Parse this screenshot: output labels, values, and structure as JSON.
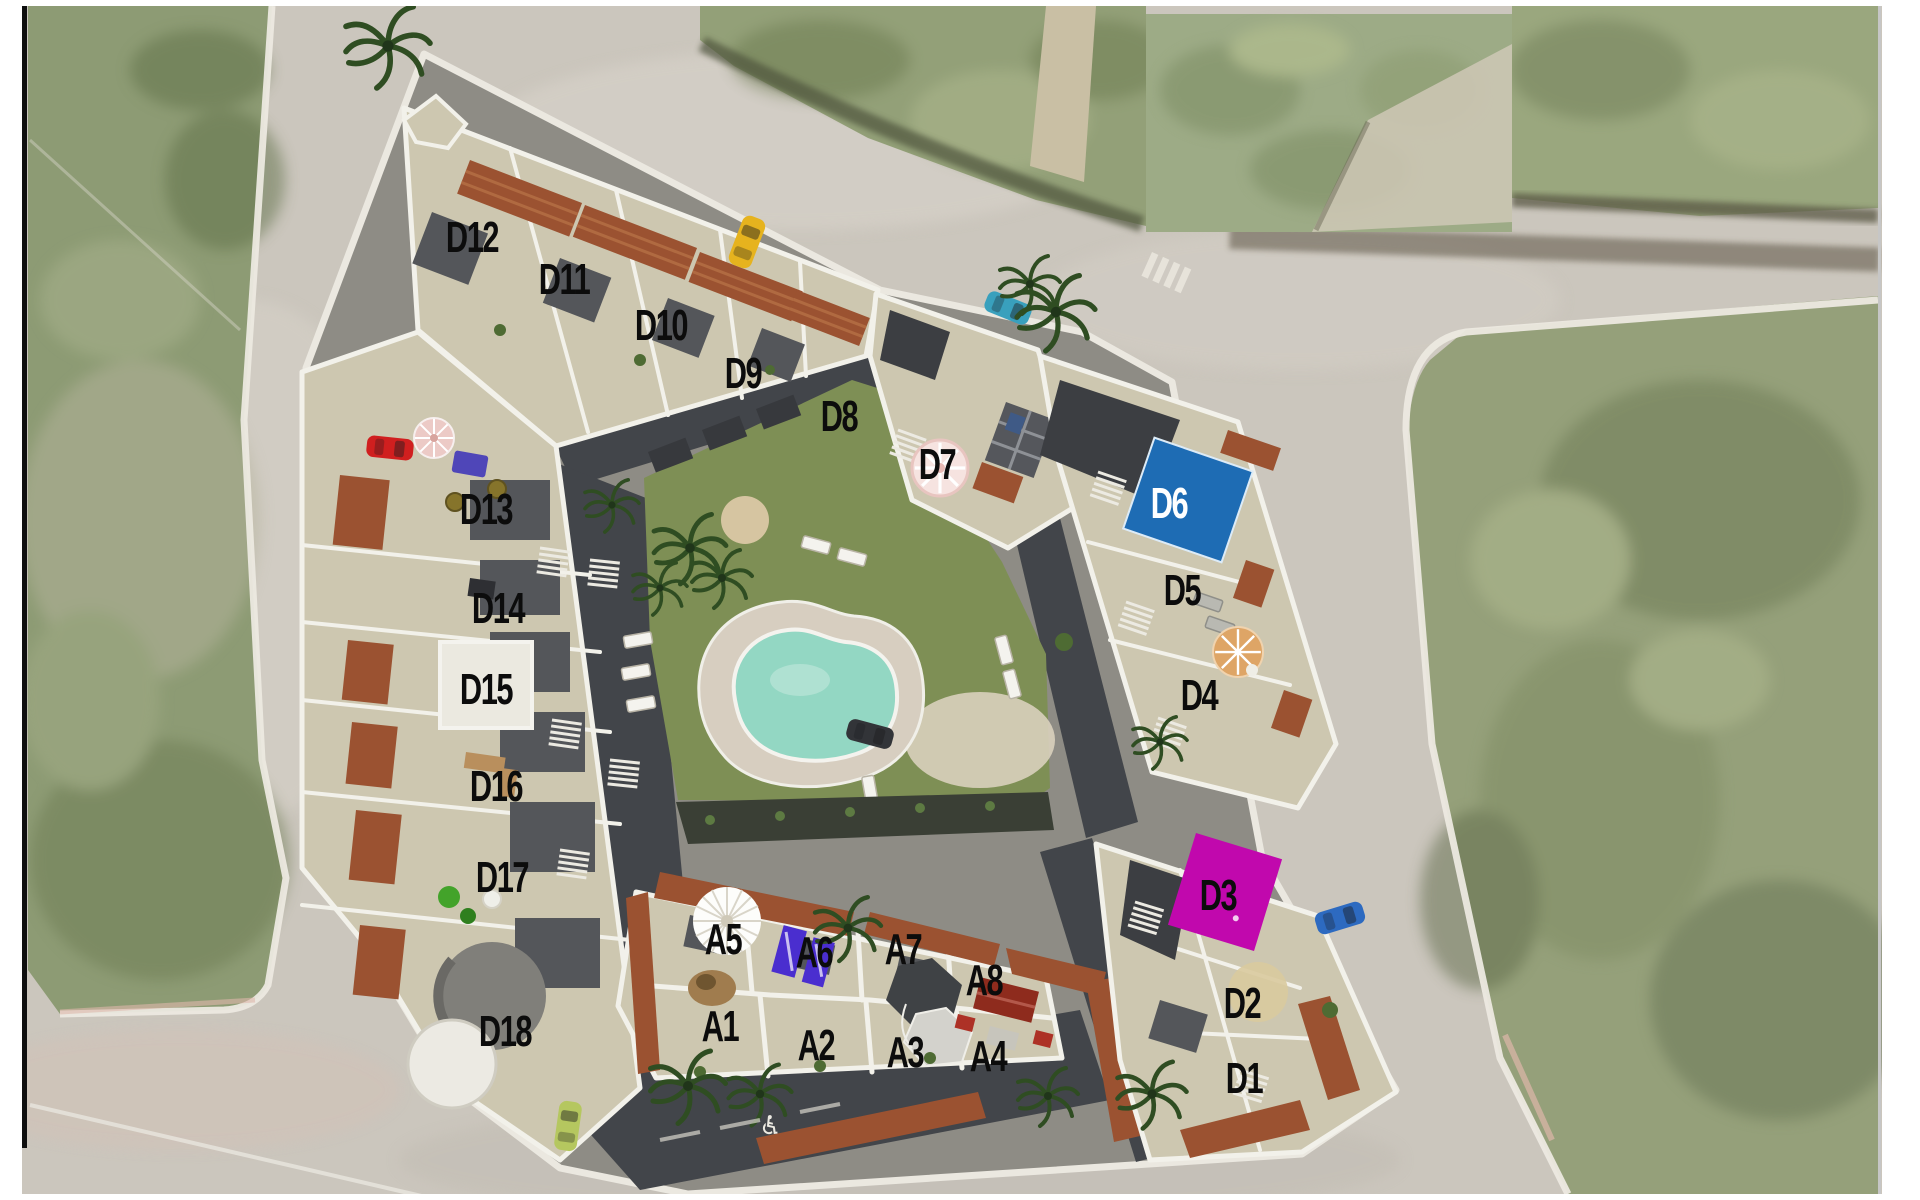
{
  "site_plan": {
    "units": {
      "d": [
        {
          "id": "d1",
          "label": "D1"
        },
        {
          "id": "d2",
          "label": "D2"
        },
        {
          "id": "d3",
          "label": "D3"
        },
        {
          "id": "d4",
          "label": "D4"
        },
        {
          "id": "d5",
          "label": "D5"
        },
        {
          "id": "d6",
          "label": "D6"
        },
        {
          "id": "d7",
          "label": "D7"
        },
        {
          "id": "d8",
          "label": "D8"
        },
        {
          "id": "d9",
          "label": "D9"
        },
        {
          "id": "d10",
          "label": "D10"
        },
        {
          "id": "d11",
          "label": "D11"
        },
        {
          "id": "d12",
          "label": "D12"
        },
        {
          "id": "d13",
          "label": "D13"
        },
        {
          "id": "d14",
          "label": "D14"
        },
        {
          "id": "d15",
          "label": "D15"
        },
        {
          "id": "d16",
          "label": "D16"
        },
        {
          "id": "d17",
          "label": "D17"
        },
        {
          "id": "d18",
          "label": "D18"
        }
      ],
      "a": [
        {
          "id": "a1",
          "label": "A1"
        },
        {
          "id": "a2",
          "label": "A2"
        },
        {
          "id": "a3",
          "label": "A3"
        },
        {
          "id": "a4",
          "label": "A4"
        },
        {
          "id": "a5",
          "label": "A5"
        },
        {
          "id": "a6",
          "label": "A6"
        },
        {
          "id": "a7",
          "label": "A7"
        },
        {
          "id": "a8",
          "label": "A8"
        }
      ]
    },
    "icons": {
      "wheelchair_glyph": "♿"
    },
    "colors": {
      "road_gray": "#cbc6bd",
      "field_green": "#8d9b74",
      "right_field_green": "#95a07a",
      "top_field_green": "#93a078",
      "patch_green": "#9dab86",
      "lawn_green": "#7e8f55",
      "pool_teal": "#93d7c3",
      "unit_d6_pool_blue": "#1e6cb4",
      "unit_d3_magenta": "#c108ad",
      "a6_purple": "#4a2ecf",
      "tile_red": "#9b5231",
      "car_yellow": "#e6b31e",
      "car_red": "#d01f1f",
      "car_teal": "#39a0bd",
      "car_blue": "#2d6ac0",
      "car_lime": "#b5c75f",
      "car_dark": "#323438",
      "label_black": "#0c0c0c"
    }
  }
}
